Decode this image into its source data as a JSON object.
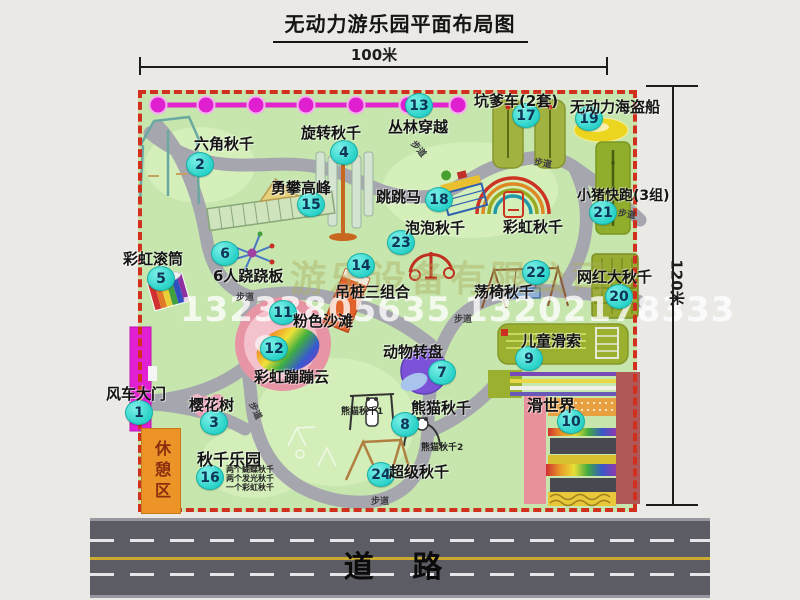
{
  "title": "无动力游乐园平面布局图",
  "dim_width": "100米",
  "dim_height": "120米",
  "road": "道  路",
  "rest_area": "休憩区",
  "watermark_company": "游乐设备有限公司",
  "watermark_phone": "13233805635 13202178333",
  "colors": {
    "map_green": "#c6e6ae",
    "boundary_red": "#d1301f",
    "badge_cyan": "#29d2c8",
    "zipline_magenta": "#e224cf",
    "path_gray": "#a6a6ae",
    "road_gray": "#5c5c64",
    "rest_area_orange": "#ec9428"
  },
  "attractions": [
    {
      "num": "1",
      "name": "风车大门",
      "bx": 138,
      "by": 411,
      "lx": 106,
      "ly": 383
    },
    {
      "num": "2",
      "name": "六角秋千",
      "bx": 199,
      "by": 163,
      "lx": 194,
      "ly": 133
    },
    {
      "num": "3",
      "name": "樱花树",
      "bx": 213,
      "by": 421,
      "lx": 189,
      "ly": 394
    },
    {
      "num": "4",
      "name": "旋转秋千",
      "bx": 343,
      "by": 151,
      "lx": 301,
      "ly": 122
    },
    {
      "num": "5",
      "name": "彩虹滚筒",
      "bx": 160,
      "by": 277,
      "lx": 123,
      "ly": 248
    },
    {
      "num": "6",
      "name": "6人跷跷板",
      "bx": 224,
      "by": 252,
      "lx": 213,
      "ly": 265
    },
    {
      "num": "7",
      "name": "动物转盘",
      "bx": 441,
      "by": 371,
      "lx": 383,
      "ly": 341
    },
    {
      "num": "8",
      "name": "熊猫秋千",
      "bx": 404,
      "by": 423,
      "lx": 411,
      "ly": 397
    },
    {
      "num": "9",
      "name": "儿童滑索",
      "bx": 528,
      "by": 357,
      "lx": 521,
      "ly": 330
    },
    {
      "num": "10",
      "name": "滑世界",
      "bx": 570,
      "by": 420,
      "lx": 527,
      "ly": 392,
      "ls": 16
    },
    {
      "num": "11",
      "name": "粉色沙滩",
      "bx": 282,
      "by": 311,
      "lx": 293,
      "ly": 310
    },
    {
      "num": "12",
      "name": "彩虹蹦蹦云",
      "bx": 273,
      "by": 347,
      "lx": 254,
      "ly": 366
    },
    {
      "num": "13",
      "name": "丛林穿越",
      "bx": 418,
      "by": 104,
      "lx": 388,
      "ly": 116
    },
    {
      "num": "14",
      "name": "吊桩三组合",
      "bx": 360,
      "by": 264,
      "lx": 335,
      "ly": 281
    },
    {
      "num": "15",
      "name": "勇攀高峰",
      "bx": 310,
      "by": 203,
      "lx": 271,
      "ly": 177
    },
    {
      "num": "16",
      "name": "秋千乐园",
      "bx": 209,
      "by": 476,
      "lx": 197,
      "ly": 446,
      "ls": 16
    },
    {
      "num": "17",
      "name": "坑爹车(2套)",
      "bx": 525,
      "by": 114,
      "lx": 474,
      "ly": 90
    },
    {
      "num": "18",
      "name": "跳跳马",
      "bx": 438,
      "by": 198,
      "lx": 376,
      "ly": 186
    },
    {
      "num": "19",
      "name": "无动力海盗船",
      "bx": 588,
      "by": 117,
      "lx": 570,
      "ly": 96
    },
    {
      "num": "20",
      "name": "网红大秋千",
      "bx": 618,
      "by": 295,
      "lx": 577,
      "ly": 266
    },
    {
      "num": "21",
      "name": "小猪快跑(3组)",
      "bx": 602,
      "by": 211,
      "lx": 577,
      "ly": 185,
      "ls": 14
    },
    {
      "num": "22",
      "name": "荡椅秋千",
      "bx": 535,
      "by": 271,
      "lx": 474,
      "ly": 281
    },
    {
      "num": "23",
      "name": "泡泡秋千",
      "bx": 400,
      "by": 241,
      "lx": 405,
      "ly": 217
    },
    {
      "num": "24",
      "name": "超级秋千",
      "bx": 380,
      "by": 473,
      "lx": 389,
      "ly": 461
    },
    {
      "num": "",
      "name": "彩虹秋千",
      "bx": 0,
      "by": 0,
      "lx": 503,
      "ly": 216
    }
  ],
  "sub_labels": [
    {
      "text": "熊猫秋千1",
      "x": 341,
      "y": 404,
      "s": 9
    },
    {
      "text": "熊猫秋千2",
      "x": 421,
      "y": 440,
      "s": 9
    },
    {
      "text": "两个蝴蝶秋千",
      "x": 226,
      "y": 464,
      "s": 8
    },
    {
      "text": "两个发光秋千",
      "x": 226,
      "y": 473,
      "s": 8
    },
    {
      "text": "一个彩虹秋千",
      "x": 226,
      "y": 482,
      "s": 8
    }
  ],
  "path_labels": [
    {
      "text": "步道",
      "x": 410,
      "y": 142,
      "r": 50
    },
    {
      "text": "步道",
      "x": 534,
      "y": 156,
      "r": 10
    },
    {
      "text": "步道",
      "x": 236,
      "y": 290,
      "r": 0
    },
    {
      "text": "步道",
      "x": 454,
      "y": 312,
      "r": 0
    },
    {
      "text": "步道",
      "x": 247,
      "y": 404,
      "r": 65
    },
    {
      "text": "步道",
      "x": 371,
      "y": 494,
      "r": 0
    },
    {
      "text": "步道",
      "x": 618,
      "y": 207,
      "r": 10
    }
  ]
}
